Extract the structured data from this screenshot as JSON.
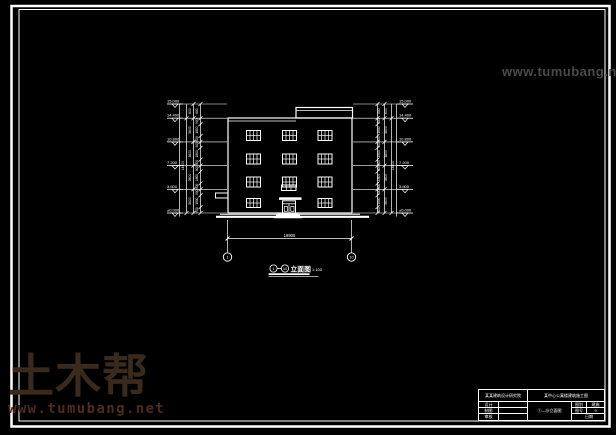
{
  "page": {
    "background": "#000000",
    "line_color": "#ffffff"
  },
  "watermark": {
    "site_url": "www.tumubang.net",
    "logo_text": "土木帮",
    "logo_color": "#3a2a1e",
    "url_color": "#4e2b1f",
    "top_right_color": "#4a4a4a"
  },
  "drawing": {
    "title": {
      "axis_start": "1",
      "axis_end": "10",
      "name": "立面图",
      "scale": "1:100"
    },
    "elevations": [
      "15.000",
      "14.400",
      "10.800",
      "7.200",
      "3.600",
      "±0.000"
    ],
    "dims": {
      "parapet": "600",
      "floor_pattern": [
        "900",
        "1800",
        "900"
      ],
      "floor_height": "3600",
      "total_height": "14400",
      "overall_width": "18900"
    },
    "axis_bubbles": {
      "left": "1",
      "right": "10"
    }
  },
  "title_block": {
    "institute": "某某建筑设计研究院",
    "project": "某中心公寓楼建筑施工图",
    "staff_rows": [
      {
        "label": "设计",
        "value": ""
      },
      {
        "label": "制图",
        "value": ""
      },
      {
        "label": "审核",
        "value": ""
      }
    ],
    "drawing_name": "①—⑩立面图",
    "meta": [
      {
        "label": "图别",
        "value": "建施"
      },
      {
        "label": "图号",
        "value": "9"
      },
      {
        "label": "日期",
        "value": ""
      }
    ]
  }
}
